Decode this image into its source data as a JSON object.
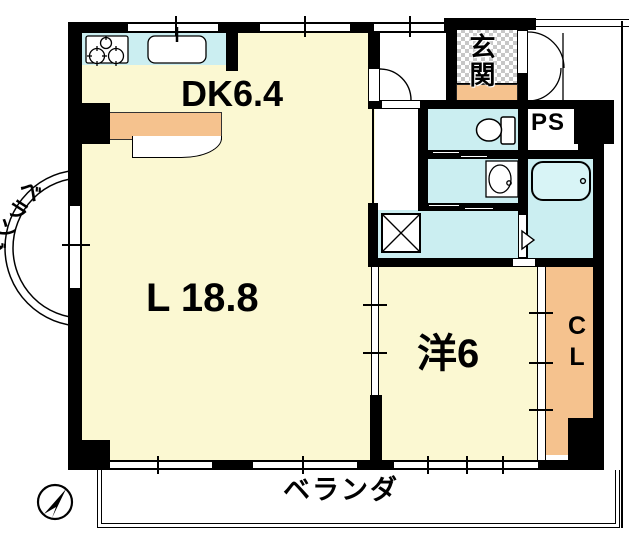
{
  "floorplan": {
    "title": "apartment-floor-plan",
    "rooms": {
      "dk": {
        "label": "DK6.4"
      },
      "living": {
        "label": "L 18.8"
      },
      "western": {
        "label": "洋6"
      },
      "closet": {
        "label": "CL"
      },
      "genkan": {
        "label": "玄関"
      },
      "pipe_space": {
        "label": "PS"
      },
      "balcony_left": {
        "label": "ベランダ"
      },
      "balcony_bottom": {
        "label": "ベランダ"
      }
    },
    "icons": [
      "north-arrow-icon",
      "stove-icon",
      "kitchen-sink-icon",
      "cabinet-icon",
      "bathtub-icon",
      "toilet-icon",
      "washbasin-icon",
      "washing-machine-icon",
      "door-swing-icon",
      "double-entry-door-icon",
      "folding-door-icon",
      "balcony-arc-icon"
    ],
    "colors": {
      "room_fill": "#FBF8D2",
      "water_fill": "#CBEEF1",
      "closet_fill": "#F5C28E",
      "wall": "#000000",
      "background": "#FFFFFF"
    }
  }
}
